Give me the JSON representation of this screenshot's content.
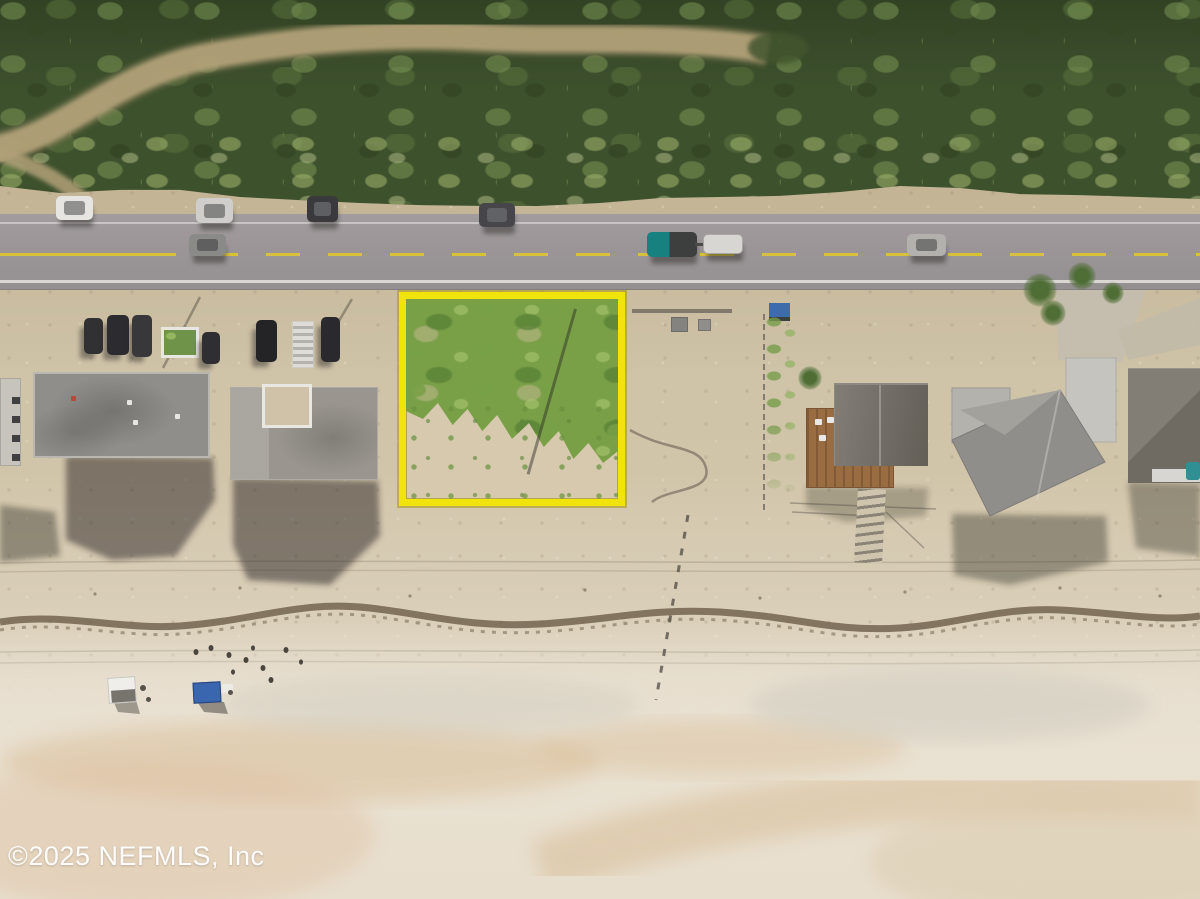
{
  "watermark": {
    "text": "©2025 NEFMLS, Inc"
  },
  "scene": {
    "type": "aerial-drone-real-estate-photo",
    "subject": "highlighted vacant beachfront lot outlined in yellow",
    "features": [
      "dense coastal vegetation band with winding sand trail at top",
      "two-lane coastal road with dashed yellow center line",
      "parked cars on road shoulder and in driveways",
      "teal pickup truck towing white trailer",
      "beach houses with flat gray roofs, gabled roof house with wooden deck",
      "dune fence posts and seaweed wrack line on beach",
      "two beach canopies (white and blue) with people on sand",
      "wet sand with tidal swirl patterns at bottom"
    ]
  },
  "objects": {
    "highlighted_lot": {
      "shape": "rectangle",
      "border_color": "#f0e40c",
      "content": "vegetated vacant lot, green scrub over sand"
    },
    "vehicles": [
      {
        "kind": "car",
        "color": "#e6e5e1",
        "location": "shoulder-parked"
      },
      {
        "kind": "car",
        "color": "#cfcecb",
        "location": "shoulder-parked"
      },
      {
        "kind": "car",
        "color": "#3a3a3c",
        "location": "shoulder-parked"
      },
      {
        "kind": "car",
        "color": "#46464a",
        "location": "shoulder-parked"
      },
      {
        "kind": "car",
        "color": "#7e7d7b",
        "location": "driving-westbound"
      },
      {
        "kind": "pickup-truck",
        "color": "#16817f",
        "location": "driving-with-trailer"
      },
      {
        "kind": "trailer",
        "color": "#d7d6d2",
        "location": "towed"
      },
      {
        "kind": "car",
        "color": "#b2b1ad",
        "location": "driving-eastbound"
      },
      {
        "kind": "car",
        "color": "#2c2c30",
        "location": "driveway-parked-row"
      }
    ],
    "canopies": [
      {
        "color_name": "white",
        "color": "#efeeea"
      },
      {
        "color_name": "blue",
        "color": "#3a66b0"
      }
    ]
  },
  "colors": {
    "veg_base": "#3e512d",
    "trail": "#b1a078",
    "road": "#a29c9e",
    "road_yellow": "#d9c13b",
    "lot_border": "#f0e40c",
    "lot_green": "#79a047",
    "roof_a": "#8f8e8a",
    "roof_b": "#9a968f",
    "roof_c": "#746f68",
    "roof_d": "#8f8e8a",
    "deck": "#9a6c42",
    "truck_teal": "#16817f",
    "sign_blue": "#3e6cab",
    "canopy_blue": "#3a66b0",
    "canopy_white": "#efeeea",
    "wrack": "#6b5d49",
    "watermark_color": "#ffffff"
  }
}
